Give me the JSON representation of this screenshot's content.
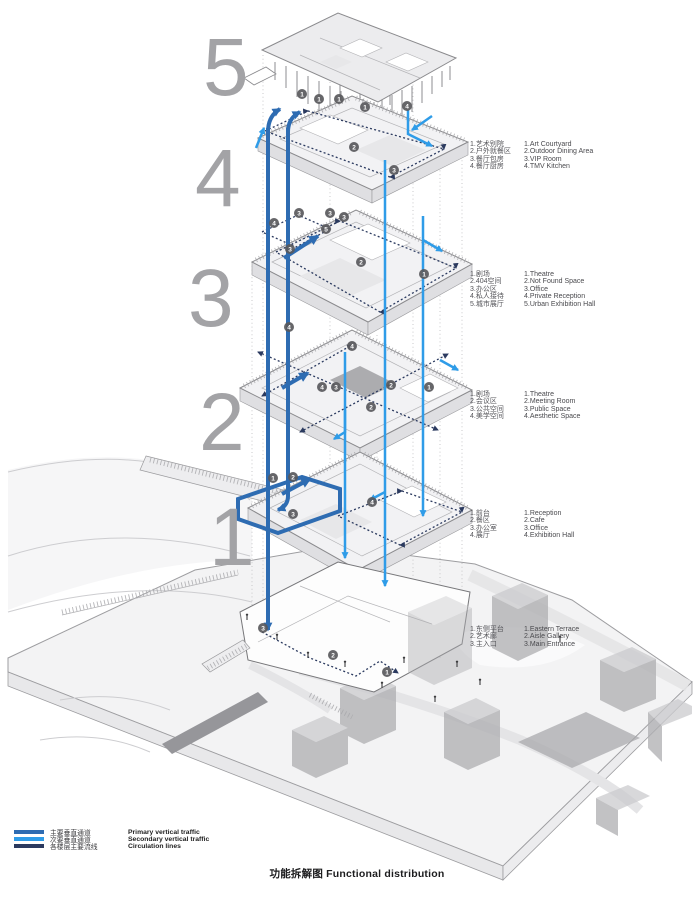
{
  "title": {
    "zh": "功能拆解图",
    "en": "Functional distribution"
  },
  "floor_numbers": [
    "5",
    "4",
    "3",
    "2",
    "1"
  ],
  "floors": [
    {
      "level": "5",
      "rows": [
        {
          "zh": "1.艺术别院",
          "en": "1.Art Courtyard"
        },
        {
          "zh": "2.户外就餐区",
          "en": "2.Outdoor Dining Area"
        },
        {
          "zh": "3.餐厅包房",
          "en": "3.VIP Room"
        },
        {
          "zh": "4.餐厅厨房",
          "en": "4.TMV Kitchen"
        }
      ]
    },
    {
      "level": "4",
      "rows": [
        {
          "zh": "1.剧场",
          "en": "1.Theatre"
        },
        {
          "zh": "2.404空间",
          "en": "2.Not Found Space"
        },
        {
          "zh": "3.办公区",
          "en": "3.Office"
        },
        {
          "zh": "4.私人接待",
          "en": "4.Private Reception"
        },
        {
          "zh": "5.城市展厅",
          "en": "5.Urban Exhibition Hall"
        }
      ]
    },
    {
      "level": "3",
      "rows": [
        {
          "zh": "1.剧场",
          "en": "1.Theatre"
        },
        {
          "zh": "2.会议区",
          "en": "2.Meeting Room"
        },
        {
          "zh": "3.公共空间",
          "en": "3.Public Space"
        },
        {
          "zh": "4.美学空间",
          "en": "4.Aesthetic Space"
        }
      ]
    },
    {
      "level": "2",
      "rows": [
        {
          "zh": "1.前台",
          "en": "1.Reception"
        },
        {
          "zh": "2.餐区",
          "en": "2.Cafe"
        },
        {
          "zh": "3.办公室",
          "en": "3.Office"
        },
        {
          "zh": "4.展厅",
          "en": "4.Exhibition Hall"
        }
      ]
    },
    {
      "level": "1",
      "rows": [
        {
          "zh": "1.东侧平台",
          "en": "1.Eastern Terrace"
        },
        {
          "zh": "2.艺术廊",
          "en": "2.Aisle Gallery"
        },
        {
          "zh": "3.主入口",
          "en": "3.Main Entrance"
        }
      ]
    }
  ],
  "legend": [
    {
      "zh": "主要垂直通道",
      "en": "Primary vertical traffic",
      "color": "#2e6cb2"
    },
    {
      "zh": "次要垂直通道",
      "en": "Secondary vertical traffic",
      "color": "#2f9ce8"
    },
    {
      "zh": "各楼层主要流线",
      "en": "Circulation lines",
      "color": "#2b3a5f"
    }
  ],
  "markers": [
    {
      "n": "1"
    },
    {
      "n": "1"
    },
    {
      "n": "1"
    },
    {
      "n": "1"
    },
    {
      "n": "4"
    },
    {
      "n": "2"
    },
    {
      "n": "3"
    },
    {
      "n": "3"
    },
    {
      "n": "3"
    },
    {
      "n": "3"
    },
    {
      "n": "4"
    },
    {
      "n": "5"
    },
    {
      "n": "3"
    },
    {
      "n": "2"
    },
    {
      "n": "1"
    },
    {
      "n": "4"
    },
    {
      "n": "4"
    },
    {
      "n": "4"
    },
    {
      "n": "3"
    },
    {
      "n": "2"
    },
    {
      "n": "1"
    },
    {
      "n": "2"
    },
    {
      "n": "1"
    },
    {
      "n": "2"
    },
    {
      "n": "3"
    },
    {
      "n": "4"
    },
    {
      "n": "3"
    },
    {
      "n": "2"
    },
    {
      "n": "1"
    }
  ],
  "colors": {
    "primary_vertical": "#2e6cb2",
    "secondary_vertical": "#2f9ce8",
    "circulation": "#2b3a5f",
    "floor_number_gray": "#a3a3a6",
    "plate_fill": "#f2f2f4",
    "terrain_fill": "#f3f3f4"
  }
}
